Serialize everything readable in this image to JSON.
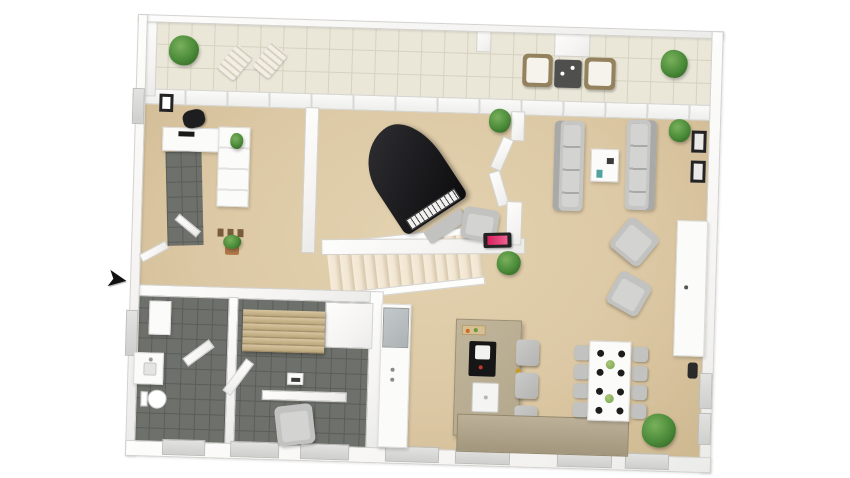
{
  "scene": {
    "type": "3d-floor-plan-render",
    "colors": {
      "canvas": "#ffffff",
      "wall-face": "#f5f4f2",
      "wall-edge": "#d3d2cf",
      "wall-bright": "#fdfdfc",
      "outer-wall": "#ebebe9",
      "floor-beige": "#dcc8a4",
      "floor-beige-dark": "#cdb890",
      "balcony-tile": "#eae7d8",
      "balcony-grout": "#d6d2bf",
      "dark-tile": "#6e706b",
      "dark-grout": "#5b5d58",
      "stair-tread": "#f1e6d2",
      "stair-edge": "#d9cbb1",
      "sofa-gray": "#c6c6c4",
      "sofa-shade": "#a9a9a7",
      "cushion": "#d3d3d1",
      "chair-gray": "#c2c2c0",
      "stool-gray": "#b4b4b2",
      "white-furn": "#fbfbfa",
      "island-taupe": "#b2a68b",
      "counter-taupe": "#bcb098",
      "wood-slat": "#d8c6a1",
      "wood-slat-dark": "#bba67a",
      "fridge-gray": "#adb3b5",
      "piano-black": "#1c1c1f",
      "plant-green": "#4a8a38",
      "plant-green-dark": "#2d5b21",
      "pot-terracotta": "#b0784a",
      "wicker-tan": "#94825f",
      "fireplace-pink": "#d81e5e",
      "frame-black": "#232323",
      "table-dark": "#4f4f4d",
      "plate-black": "#1d1d1d",
      "centerpiece-green": "#7ba04c",
      "brass": "#c69b26",
      "arrow-black": "#111111"
    }
  },
  "floorplan": {
    "entrance_arrow_glyph": "➤",
    "rooms": [
      {
        "name": "balcony",
        "floor": "light-tile",
        "items": [
          "potted-plant",
          "sun-lounger",
          "sun-lounger",
          "wicker-armchair",
          "side-table",
          "wicker-armchair",
          "potted-plant"
        ]
      },
      {
        "name": "entry-hall",
        "floor": "beige-and-dark-tile",
        "items": [
          "office-chair",
          "dresser",
          "wardrobe",
          "wall-frame",
          "potted-plant",
          "shoes",
          "floor-plant",
          "open-door"
        ]
      },
      {
        "name": "music-room",
        "floor": "beige",
        "items": [
          "grand-piano",
          "piano-bench",
          "potted-plant",
          "armchair",
          "wall-fireplace",
          "double-doors"
        ]
      },
      {
        "name": "living-room",
        "floor": "beige",
        "items": [
          "sofa",
          "sofa",
          "coffee-table",
          "armchair",
          "armchair",
          "sideboard",
          "wall-frames",
          "potted-plant",
          "potted-plant",
          "wall-panel"
        ]
      },
      {
        "name": "kitchen",
        "floor": "beige",
        "items": [
          "tall-cabinet",
          "refrigerator",
          "kitchen-island",
          "cooktop",
          "sink",
          "cutting-board",
          "bar-stools",
          "kitchen-counter"
        ]
      },
      {
        "name": "dining-area",
        "floor": "beige",
        "items": [
          "dining-table",
          "dining-chairs",
          "place-settings",
          "centerpieces",
          "potted-plant"
        ]
      },
      {
        "name": "bathroom",
        "floor": "dark-tile",
        "items": [
          "toilet",
          "vanity-sink",
          "cabinet",
          "open-door"
        ]
      },
      {
        "name": "sauna-relax-room",
        "floor": "dark-tile",
        "items": [
          "tiered-wood-bench",
          "sauna-heater",
          "armchair",
          "half-wall",
          "open-door"
        ]
      },
      {
        "name": "staircase",
        "items": [
          "stairs"
        ]
      }
    ]
  },
  "counts": {
    "stair_steps": 13,
    "bar_stools": 3,
    "dining_chairs_per_side": 4,
    "place_settings_per_side": 4,
    "centerpieces": 2,
    "right_wall_frames": 2,
    "bottom_windows": 7,
    "sauna_bench_slats": 6
  }
}
